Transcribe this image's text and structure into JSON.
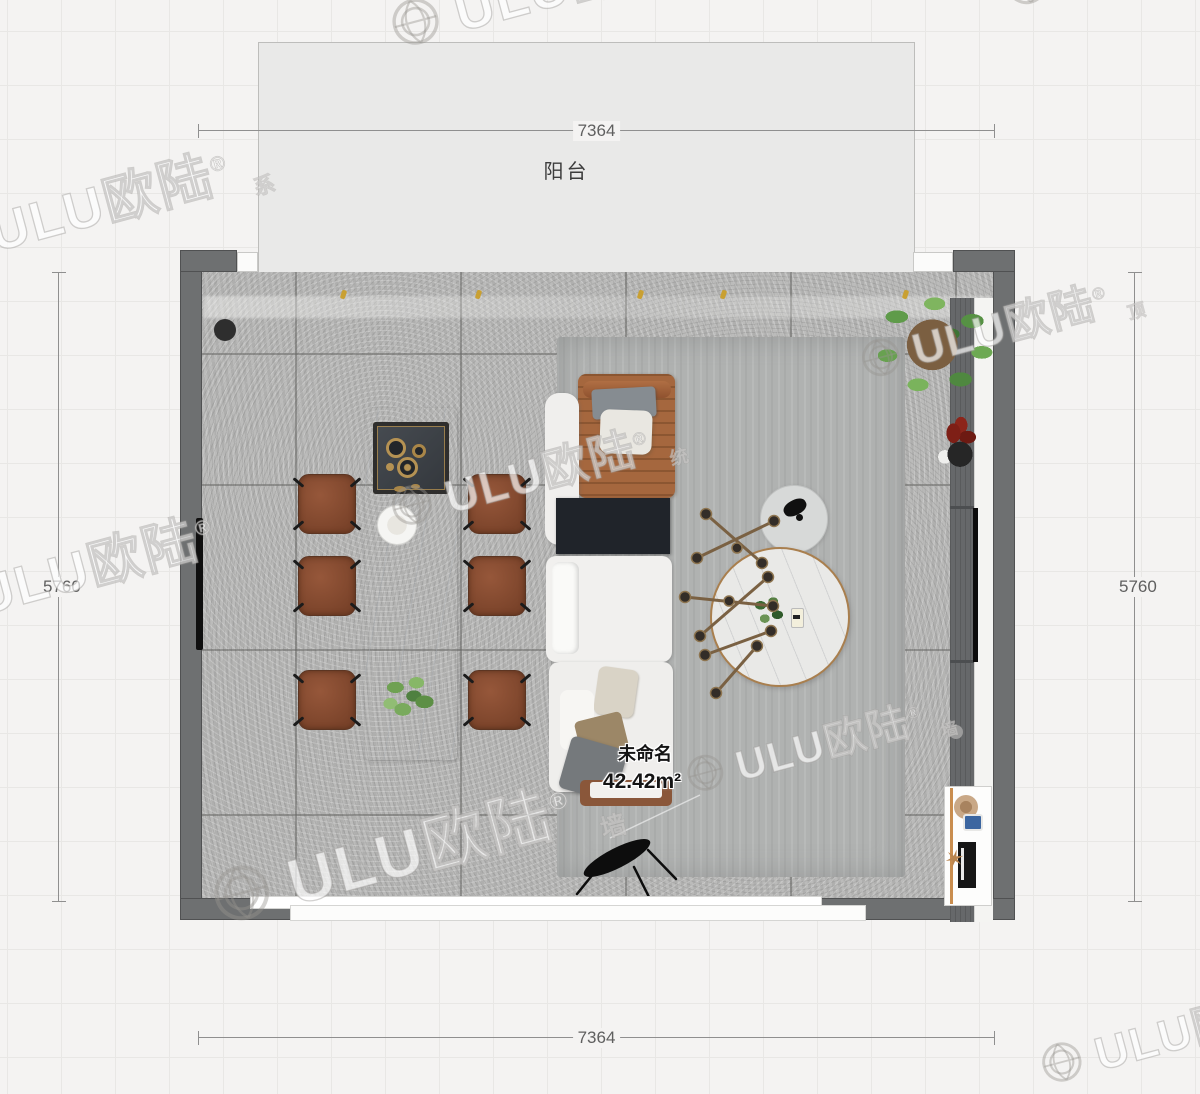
{
  "dimensions": {
    "top": "7364",
    "bottom": "7364",
    "left": "5760",
    "right": "5760"
  },
  "labels": {
    "balcony": "阳台",
    "room_name": "未命名",
    "room_area": "42.42m²"
  },
  "watermark": {
    "brand": "ULU欧陆",
    "reg": "®",
    "subs": [
      "系",
      "顶",
      "统",
      "墙",
      "装"
    ]
  },
  "icons": {
    "wood_ornament": "✶"
  },
  "colors": {
    "page_bg": "#f4f3f2",
    "grid_line": "#e8e7e5",
    "wall": "#6e7071",
    "floor_tile": "#b6b6b5",
    "rug": "#b0b2b1",
    "balcony_fill": "#e9e9e8",
    "chair_brown": "#8a4f33",
    "chaise_caramel": "#a5673e",
    "sofa_white": "#f1f0ee",
    "black_table": "#20242a",
    "brass": "#a97f4e",
    "dimension_line": "#8f8f8f",
    "dimension_text": "#5f5f5f",
    "spotlight_gold": "#c9a032"
  },
  "furniture": [
    {
      "id": "dining-island",
      "label": "white marble kitchen island"
    },
    {
      "id": "cooktop",
      "label": "dark cooktop with brass burners"
    },
    {
      "id": "dining-chair",
      "label": "brown leather dining chair",
      "count": 6
    },
    {
      "id": "table-plant",
      "label": "greenery on island"
    },
    {
      "id": "area-rug",
      "label": "gray area rug"
    },
    {
      "id": "chaise-lounge",
      "label": "caramel chaise with pillows"
    },
    {
      "id": "modular-sofa",
      "label": "white modular sofa"
    },
    {
      "id": "sofa-side-table",
      "label": "black low table"
    },
    {
      "id": "ottoman",
      "label": "brown ottoman bench"
    },
    {
      "id": "floor-lamp",
      "label": "black floor lamp"
    },
    {
      "id": "coffee-table",
      "label": "round marble coffee table with brass rim"
    },
    {
      "id": "side-table",
      "label": "small round side table"
    },
    {
      "id": "pendant-light",
      "label": "sputnik pendant lamp"
    },
    {
      "id": "potted-plant",
      "label": "large potted plant"
    },
    {
      "id": "flower-arrangement",
      "label": "red flowers in black vase"
    },
    {
      "id": "media-cabinet",
      "label": "media wall cabinet"
    },
    {
      "id": "tv",
      "label": "wall-mounted TV"
    },
    {
      "id": "desk",
      "label": "desk with chair and monitor"
    },
    {
      "id": "floor-drain",
      "label": "floor drain"
    },
    {
      "id": "bottom-window",
      "label": "window in bottom wall"
    }
  ]
}
